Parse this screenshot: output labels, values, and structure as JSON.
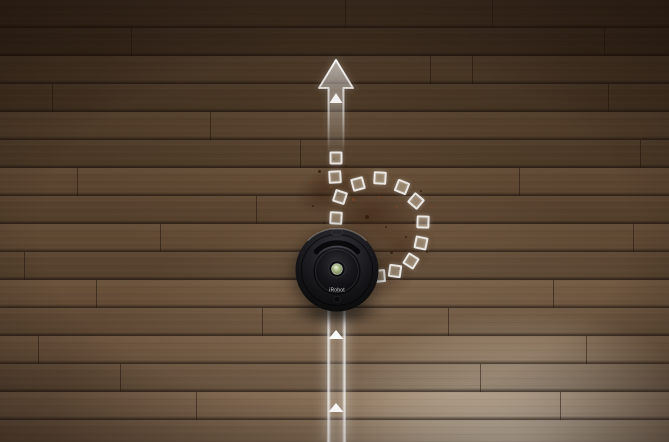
{
  "scene": {
    "description": "iRobot Roomba robotic vacuum on a dark hardwood floor with a white overlay graphic showing its cleaning path: a straight arrow ahead and a dashed-square loop circling a dirt patch (Dirt Detect behavior)"
  },
  "robot": {
    "brand_text": "iRobot",
    "body_color": "#141417",
    "button_color": "#a8b685"
  },
  "overlay": {
    "color": "#ffffff",
    "arrow_direction": "up",
    "band_triangles": [
      {
        "x": 336,
        "y": 330
      },
      {
        "x": 336,
        "y": 403
      }
    ],
    "dash_squares": [
      {
        "x": 336,
        "y": 158,
        "r": 0
      },
      {
        "x": 335,
        "y": 177,
        "r": -3
      },
      {
        "x": 340,
        "y": 197,
        "r": 18
      },
      {
        "x": 336,
        "y": 218,
        "r": 3
      },
      {
        "x": 358,
        "y": 184,
        "r": -15
      },
      {
        "x": 380,
        "y": 178,
        "r": 3
      },
      {
        "x": 402,
        "y": 187,
        "r": 22
      },
      {
        "x": 416,
        "y": 201,
        "r": 40
      },
      {
        "x": 423,
        "y": 222,
        "r": 2
      },
      {
        "x": 421,
        "y": 243,
        "r": 12
      },
      {
        "x": 411,
        "y": 261,
        "r": 32
      },
      {
        "x": 395,
        "y": 271,
        "r": 8
      },
      {
        "x": 379,
        "y": 276,
        "r": -5
      }
    ]
  },
  "floor": {
    "base_color": "#5b4530",
    "seam_color": "#2a180c",
    "hotspot_color": "#f2e7d5",
    "plank_joints": [
      {
        "x": 131,
        "y": 28
      },
      {
        "x": 345,
        "y": 0
      },
      {
        "x": 52,
        "y": 84
      },
      {
        "x": 472,
        "y": 56
      },
      {
        "x": 210,
        "y": 112
      },
      {
        "x": 608,
        "y": 84
      },
      {
        "x": 77,
        "y": 168
      },
      {
        "x": 300,
        "y": 140
      },
      {
        "x": 519,
        "y": 168
      },
      {
        "x": 160,
        "y": 224
      },
      {
        "x": 430,
        "y": 56
      },
      {
        "x": 633,
        "y": 224
      },
      {
        "x": 96,
        "y": 280
      },
      {
        "x": 553,
        "y": 280
      },
      {
        "x": 38,
        "y": 336
      },
      {
        "x": 262,
        "y": 308
      },
      {
        "x": 480,
        "y": 364
      },
      {
        "x": 196,
        "y": 392
      },
      {
        "x": 586,
        "y": 336
      },
      {
        "x": 120,
        "y": 364
      },
      {
        "x": 24,
        "y": 252
      },
      {
        "x": 492,
        "y": 0
      },
      {
        "x": 640,
        "y": 140
      },
      {
        "x": 560,
        "y": 392
      },
      {
        "x": 256,
        "y": 196
      },
      {
        "x": 448,
        "y": 308
      },
      {
        "x": 604,
        "y": 28
      }
    ]
  },
  "dirt": {
    "colors": [
      "#301b0d",
      "#7a4526"
    ],
    "speckles": [
      {
        "x": 318,
        "y": 170,
        "s": 3,
        "c": 0
      },
      {
        "x": 330,
        "y": 186,
        "s": 2,
        "c": 1
      },
      {
        "x": 312,
        "y": 205,
        "s": 2,
        "c": 0
      },
      {
        "x": 345,
        "y": 165,
        "s": 2,
        "c": 0
      },
      {
        "x": 352,
        "y": 198,
        "s": 3,
        "c": 1
      },
      {
        "x": 341,
        "y": 231,
        "s": 2,
        "c": 0
      },
      {
        "x": 365,
        "y": 215,
        "s": 4,
        "c": 0
      },
      {
        "x": 372,
        "y": 241,
        "s": 2,
        "c": 1
      },
      {
        "x": 358,
        "y": 251,
        "s": 3,
        "c": 0
      },
      {
        "x": 385,
        "y": 226,
        "s": 2,
        "c": 0
      },
      {
        "x": 396,
        "y": 206,
        "s": 2,
        "c": 1
      },
      {
        "x": 390,
        "y": 251,
        "s": 3,
        "c": 0
      },
      {
        "x": 405,
        "y": 236,
        "s": 2,
        "c": 0
      },
      {
        "x": 378,
        "y": 196,
        "s": 2,
        "c": 1
      },
      {
        "x": 413,
        "y": 221,
        "s": 2,
        "c": 0
      },
      {
        "x": 398,
        "y": 268,
        "s": 2,
        "c": 0
      },
      {
        "x": 370,
        "y": 268,
        "s": 3,
        "c": 1
      },
      {
        "x": 349,
        "y": 276,
        "s": 2,
        "c": 0
      },
      {
        "x": 426,
        "y": 251,
        "s": 2,
        "c": 0
      },
      {
        "x": 431,
        "y": 206,
        "s": 2,
        "c": 1
      },
      {
        "x": 333,
        "y": 158,
        "s": 2,
        "c": 0
      },
      {
        "x": 420,
        "y": 190,
        "s": 2,
        "c": 0
      },
      {
        "x": 310,
        "y": 181,
        "s": 2,
        "c": 1
      },
      {
        "x": 323,
        "y": 222,
        "s": 2,
        "c": 0
      }
    ]
  }
}
